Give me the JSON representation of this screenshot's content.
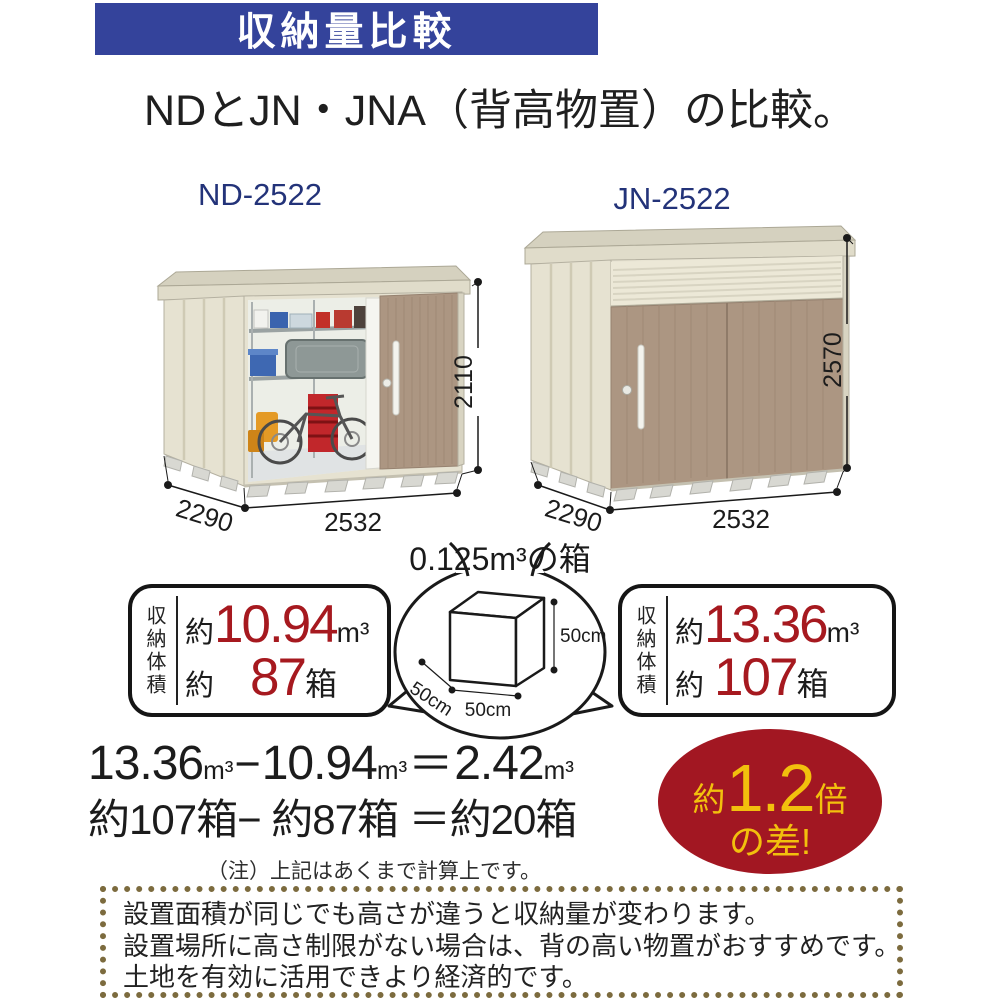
{
  "banner": {
    "label": "収納量比較",
    "bg": "#34439B",
    "fg": "#FFFFFF"
  },
  "heading": "NDとJN・JNA（背高物置）の比較。",
  "sheds": {
    "left": {
      "model": "ND-2522",
      "width": "2532",
      "depth": "2290",
      "height": "2110"
    },
    "right": {
      "model": "JN-2522",
      "width": "2532",
      "depth": "2290",
      "height": "2570"
    }
  },
  "reference_box": {
    "title": "0.125m³の箱",
    "height": "50cm",
    "depth": "50cm",
    "width": "50cm"
  },
  "stats": {
    "left": {
      "label": "収納体積",
      "volume_approx": "約",
      "volume": "10.94",
      "volume_unit": "m³",
      "boxes_approx": "約",
      "boxes": "87",
      "boxes_unit": "箱"
    },
    "right": {
      "label": "収納体積",
      "volume_approx": "約",
      "volume": "13.36",
      "volume_unit": "m³",
      "boxes_approx": "約",
      "boxes": "107",
      "boxes_unit": "箱"
    }
  },
  "calc": {
    "v1": "13.36",
    "v1u": "m³",
    "minus": "−",
    "v2": "10.94",
    "v2u": "m³",
    "eq": "＝",
    "v3": "2.42",
    "v3u": "m³",
    "line2": "約107箱− 約87箱 ＝約20箱",
    "note": "（注）上記はあくまで計算上です。"
  },
  "badge": {
    "prefix": "約",
    "value": "1.2",
    "suffix": "倍",
    "line2": "の差!",
    "bg": "#A21722",
    "fg": "#F2C00D"
  },
  "footer_note": {
    "lines": [
      "設置面積が同じでも高さが違うと収納量が変わります。",
      "設置場所に高さ制限がない場合は、背の高い物置がおすすめです。",
      "土地を有効に活用できより経済的です。"
    ]
  },
  "colors": {
    "banner_blue": "#34439B",
    "model_blue": "#233379",
    "number_red": "#A6191F",
    "dotted_border": "#7C6B3E"
  }
}
